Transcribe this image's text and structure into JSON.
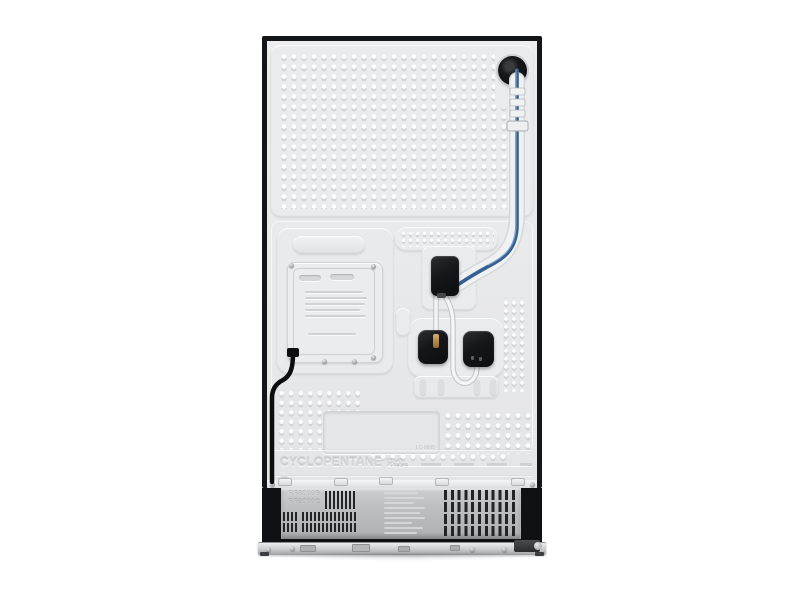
{
  "product": {
    "subject": "Refrigerator back panel product photo"
  },
  "markings": {
    "insulation_en": "CYCLOPENTANE",
    "insulation_cn": "环戊烷",
    "model_line1": "RF8000B",
    "model_line2": "RF9000C",
    "label_code": "LC-9995"
  },
  "colors": {
    "background": "#ffffff",
    "frame_black": "#141519",
    "panel_gray": "#e9eaec",
    "vent_panel_gray": "#bdbfc1",
    "tube_blue": "#3a6695",
    "valve_black": "#1a1b1e",
    "brass_fitting": "#b68a44"
  }
}
